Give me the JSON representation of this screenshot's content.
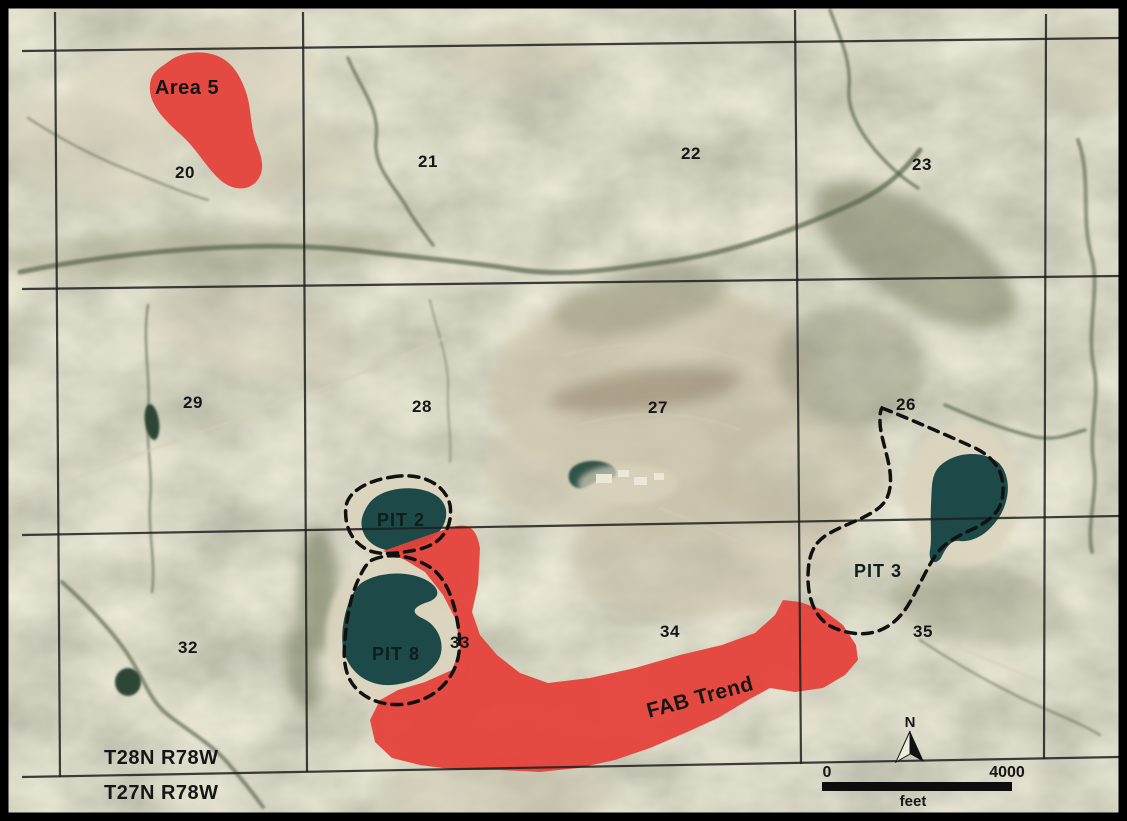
{
  "map": {
    "description": "Annotated aerial photograph with township/range section grid, highlighted mineral trend areas and pit outlines",
    "labels": {
      "area5": "Area 5",
      "fab_trend": "FAB Trend",
      "pit2": "PIT 2",
      "pit8": "PIT 8",
      "pit3": "PIT 3"
    },
    "sections": [
      "20",
      "21",
      "22",
      "23",
      "29",
      "28",
      "27",
      "26",
      "32",
      "33",
      "34",
      "35"
    ],
    "townships": {
      "north": "T28N R78W",
      "south": "T27N R78W"
    },
    "scale_bar": {
      "start": "0",
      "end": "4000",
      "unit": "feet"
    },
    "compass": {
      "label": "N"
    },
    "colors": {
      "highlight": "#e5423b",
      "water": "#1d4a49",
      "grid": "#1e1e1e",
      "outline": "#111111",
      "terrain": "#aba88a",
      "sand": "#dcd5bf"
    }
  }
}
